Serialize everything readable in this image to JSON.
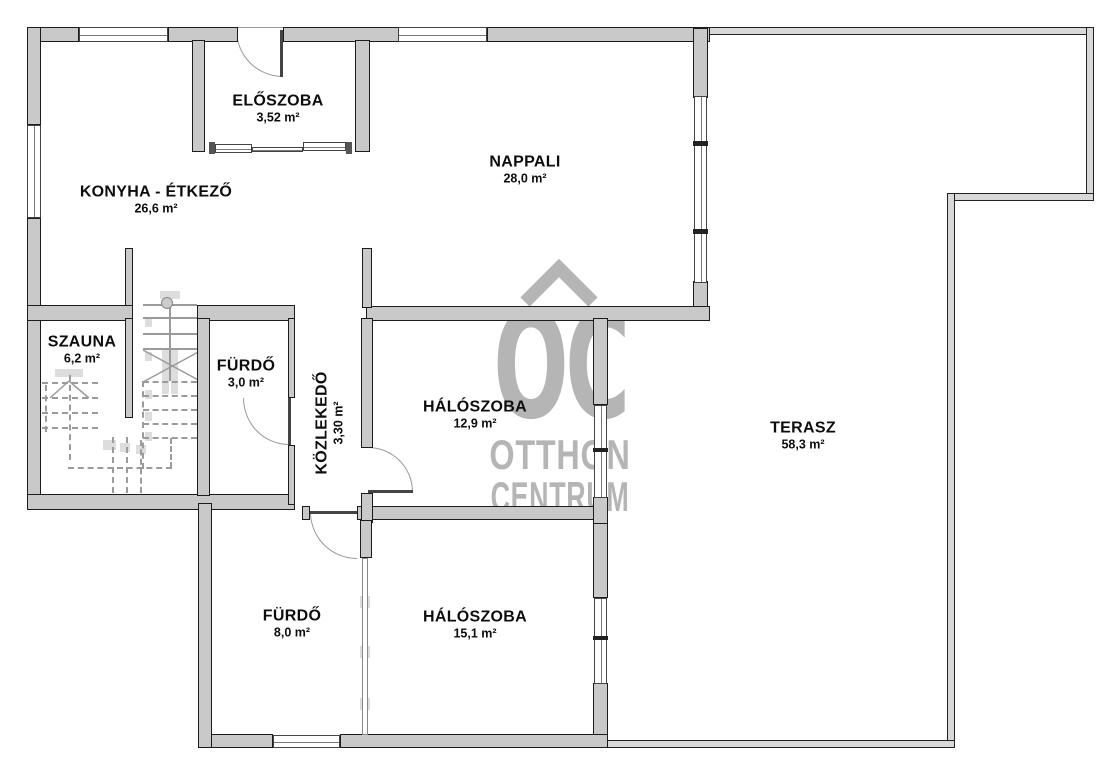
{
  "watermark": {
    "monogram": "OC",
    "line1": "OTTHON",
    "line2": "CENTRUM"
  },
  "rooms": {
    "eloszoba": {
      "name": "ELŐSZOBA",
      "area": "3,52 m²"
    },
    "nappali": {
      "name": "NAPPALI",
      "area": "28,0 m²"
    },
    "konyha": {
      "name": "KONYHA - ÉTKEZŐ",
      "area": "26,6 m²"
    },
    "szauna": {
      "name": "SZAUNA",
      "area": "6,2 m²"
    },
    "furdo_kicsi": {
      "name": "FÜRDŐ",
      "area": "3,0 m²"
    },
    "kozlekedo": {
      "name": "KÖZLEKEDŐ",
      "area": "3,30 m²"
    },
    "haloszoba_1": {
      "name": "HÁLÓSZOBA",
      "area": "12,9 m²"
    },
    "terasz": {
      "name": "TERASZ",
      "area": "58,3 m²"
    },
    "furdo_nagy": {
      "name": "FÜRDŐ",
      "area": "8,0 m²"
    },
    "haloszoba_2": {
      "name": "HÁLÓSZOBA",
      "area": "15,1 m²"
    }
  },
  "colors": {
    "wall_fill": "#c9c9c9",
    "wall_outline": "#1c1c1c",
    "terrace_wall_fill": "#d8d8d8",
    "watermark_gray": "#b5b5b5",
    "floor": "#ffffff"
  }
}
